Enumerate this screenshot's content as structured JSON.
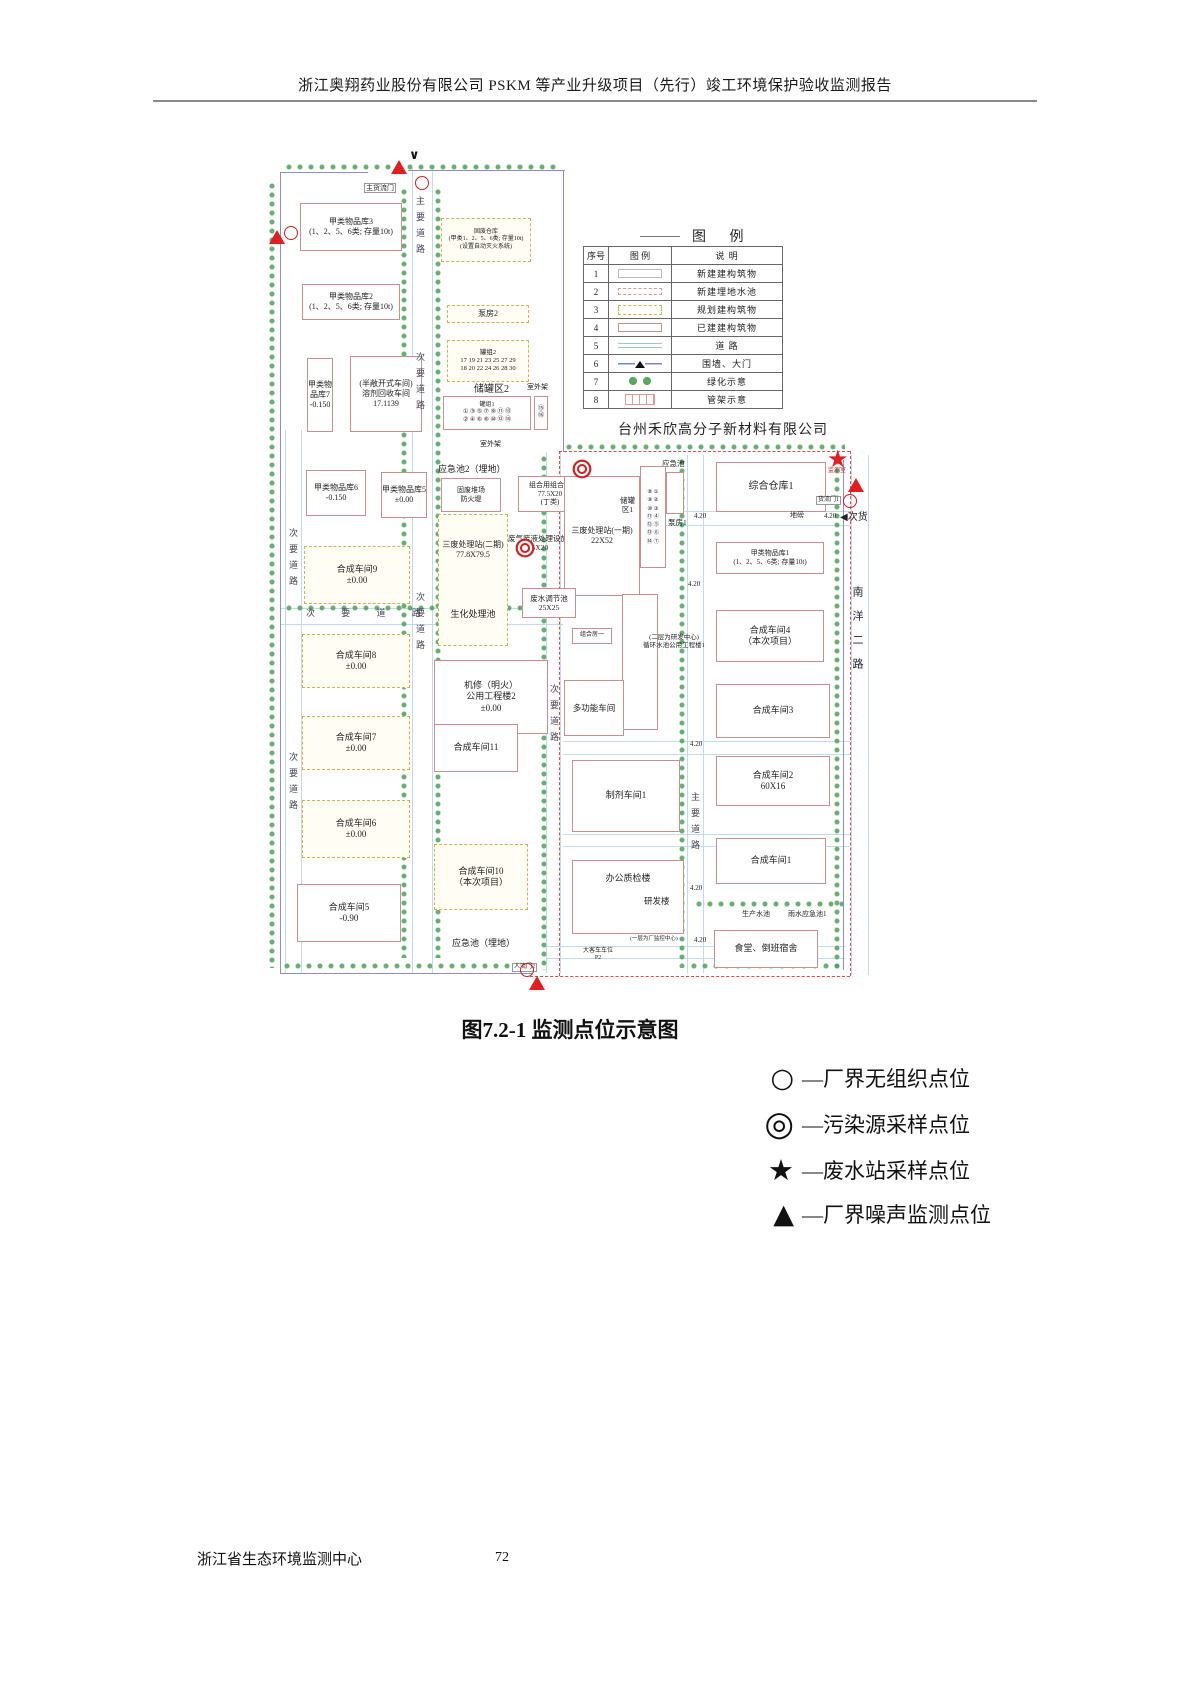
{
  "page": {
    "header_title": "浙江奥翔药业股份有限公司 PSKM 等产业升级项目（先行）竣工环境保护验收监测报告",
    "caption": "图7.2-1  监测点位示意图",
    "footer_left": "浙江省生态环境监测中心",
    "footer_page": "72"
  },
  "legend_table": {
    "title": "图  例",
    "headers": [
      "序号",
      "图  例",
      "说  明"
    ],
    "rows": [
      {
        "no": "1",
        "swatch": "new-building-outline",
        "desc": "新建建构筑物"
      },
      {
        "no": "2",
        "swatch": "new-buried-pool-dashed",
        "desc": "新建埋地水池"
      },
      {
        "no": "3",
        "swatch": "planned-building-yellow-dashed",
        "desc": "规划建构筑物"
      },
      {
        "no": "4",
        "swatch": "existing-building-pink",
        "desc": "已建建构筑物"
      },
      {
        "no": "5",
        "swatch": "road-lines",
        "desc": "道  路"
      },
      {
        "no": "6",
        "swatch": "wall-and-gate",
        "desc": "围墙、大门"
      },
      {
        "no": "7",
        "swatch": "greenery-dots",
        "desc": "绿化示意"
      },
      {
        "no": "8",
        "swatch": "pipe-rack",
        "desc": "管架示意"
      }
    ]
  },
  "marker_legend": {
    "items": [
      {
        "symbol": "○",
        "label": "—厂界无组织点位"
      },
      {
        "symbol": "◎",
        "label": "—污染源采样点位"
      },
      {
        "symbol": "★",
        "label": "—废水站采样点位"
      },
      {
        "symbol": "▲",
        "label": "—厂界噪声监测点位"
      }
    ]
  },
  "map": {
    "company_right": "台州禾欣高分子新材料有限公司",
    "symbols": {
      "star": "★",
      "chevron_down": "∨",
      "arrow_left": "◀"
    },
    "gates": {
      "main_goods": "主货流门",
      "people": "人流门2",
      "goods1": "货流门1",
      "secondary_goods": "次货",
      "monitor_room": "监测室"
    },
    "roads": {
      "main": "主要道路",
      "secondary": "次要道路",
      "secondary_sp": "次 要 道 路",
      "south": "南洋二路",
      "elev": "4.20",
      "weighbridge": "地磅"
    },
    "b": {
      "jia3": "甲类物品库3\n(1、2、5、6类; 存量10t)",
      "guf": "固废仓库\n(甲类1、2、5、6类; 存量10t)\n(设置自动灭火系统)",
      "jia2": "甲类物品库2\n(1、2、5、6类; 存量10t)",
      "beng2": "泵房2",
      "guanzu2": "罐组2\n17 19 21 23 25 27 29\n18 20 22 24 26 28 30",
      "cgq2": "储罐区2",
      "guanzu1": "罐组1\n① ③ ⑤ ⑦ ⑨ ⑪ ⑬\n② ④ ⑥ ⑧ ⑩ ⑫ ⑭",
      "g1516": "⑮\n⑯",
      "jia7": "甲类物品库7\n-0.150",
      "rongji": "(半敞开式车间)\n溶剂回收车间\n17.1139",
      "rack": "室外架",
      "yjc2": "应急池2（埋地）",
      "gufdc": "固废堆场\n防火堤",
      "jia6": "甲类物品库6\n-0.150",
      "jia5": "甲类物品库5\n±0.00",
      "zhc": "组合用组合池\n77.5X20\n(丁类)",
      "sfz2": "三废处理站(二期)\n77.8X79.5",
      "shc": "生化处理池",
      "fqfy": "废气废液处理设施\n25X20",
      "sfz1": "三废处理站(一期)\n22X52",
      "fstj": "废水调节池\n25X25",
      "syn9": "合成车间9\n±0.00",
      "util2": "机修（明火）\n公用工程楼2\n±0.00",
      "syn8": "合成车间8\n±0.00",
      "syn7": "合成车间7\n±0.00",
      "syn6": "合成车间6\n±0.00",
      "syn5": "合成车间5\n-0.90",
      "syn11": "合成车间11",
      "syn10": "合成车间10\n（本次项目）",
      "yjc_b": "应急池（埋地）",
      "bus": "大客车车位\nP2",
      "yjc_r": "应急池",
      "beng1": "泵房1",
      "store1": "综合仓库1",
      "cgq1": "储罐\n区1",
      "cgq1n": "⑧ ①\n⑨ ②\n⑩ ③\n⑪ ④\n⑫ ⑤\n⑬ ⑥\n⑭ ⑦",
      "jiaR1": "甲类物品库1\n(1、2、5、6类; 存量10t)",
      "syn4": "合成车间4\n（本次项目）",
      "xhsc": "(二层为研发中心)\n循环水池公用工程楼1",
      "multi": "多功能车间",
      "zhf1": "组合房一",
      "syn3": "合成车间3",
      "syn2": "合成车间2\n60X16",
      "syn1": "合成车间1",
      "prep1": "制剂车间1",
      "office": "办公质检楼",
      "rdb": "研发楼",
      "jkzx": "(一层为厂监控中心)",
      "canteen": "食堂、倒班宿舍",
      "scsc": "生产水池",
      "ysyjc1": "雨水应急池1"
    }
  }
}
